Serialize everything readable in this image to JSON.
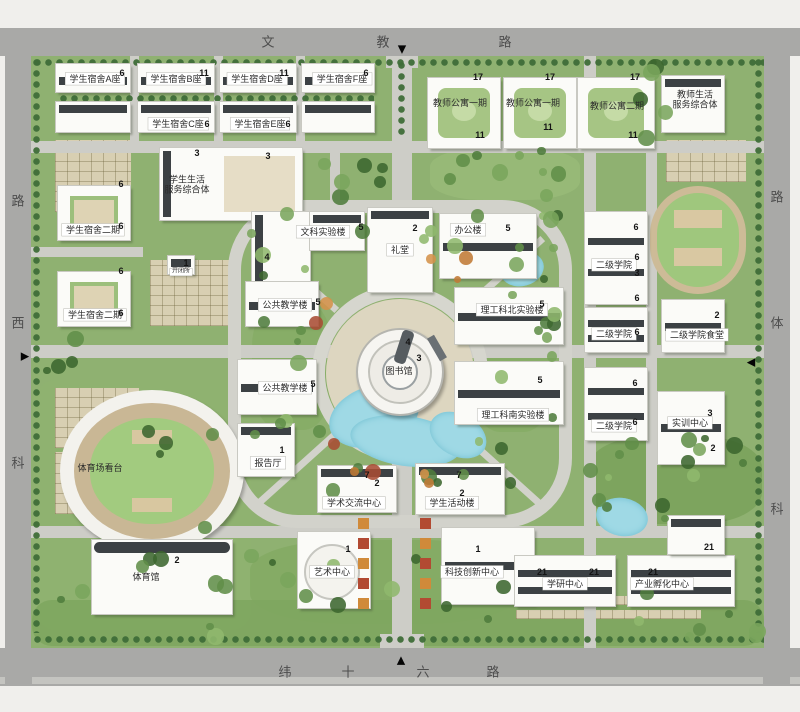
{
  "title": "校园总平面图",
  "colors": {
    "campus_green": "#8fb171",
    "road_gray": "#cdcdc7",
    "outer_road_gray": "#a9a9a7",
    "water_cyan": "#9fd9e5",
    "building_white": "#fbfbf8",
    "building_dark_bar": "#3c4144",
    "court_tan": "#d8cfb2",
    "planter_orange": "#d08a3a",
    "planter_red": "#b24a32"
  },
  "roads": {
    "north": {
      "name": "文教路",
      "chars": [
        {
          "c": "文",
          "x": 268,
          "y": 41
        },
        {
          "c": "教",
          "x": 383,
          "y": 41
        },
        {
          "c": "路",
          "x": 505,
          "y": 41
        }
      ]
    },
    "south": {
      "name": "纬十六路",
      "chars": [
        {
          "c": "纬",
          "x": 285,
          "y": 671
        },
        {
          "c": "十",
          "x": 348,
          "y": 671
        },
        {
          "c": "六",
          "x": 423,
          "y": 671
        },
        {
          "c": "路",
          "x": 493,
          "y": 671
        }
      ]
    },
    "west": {
      "name": "科西路",
      "chars": [
        {
          "c": "路",
          "x": 18,
          "y": 200
        },
        {
          "c": "西",
          "x": 18,
          "y": 322
        },
        {
          "c": "科",
          "x": 18,
          "y": 462
        }
      ]
    },
    "east": {
      "name": "科体路",
      "chars": [
        {
          "c": "路",
          "x": 777,
          "y": 196
        },
        {
          "c": "体",
          "x": 777,
          "y": 322
        },
        {
          "c": "科",
          "x": 777,
          "y": 508
        }
      ]
    }
  },
  "gates": [
    {
      "id": "north-gate",
      "sym": "▼",
      "x": 402,
      "y": 49
    },
    {
      "id": "south-gate",
      "sym": "▲",
      "x": 401,
      "y": 660
    },
    {
      "id": "west-gate",
      "sym": "▶",
      "x": 25,
      "y": 356
    },
    {
      "id": "east-gate",
      "sym": "◀",
      "x": 751,
      "y": 362
    }
  ],
  "labels": [
    {
      "id": "dorm-a",
      "text": "学生宿舍A座",
      "x": 95,
      "y": 79,
      "box": true
    },
    {
      "id": "dorm-b",
      "text": "学生宿舍B座",
      "x": 176,
      "y": 79,
      "box": true
    },
    {
      "id": "dorm-d",
      "text": "学生宿舍D座",
      "x": 257,
      "y": 79,
      "box": true
    },
    {
      "id": "dorm-f",
      "text": "学生宿舍F座",
      "x": 342,
      "y": 79,
      "box": true
    },
    {
      "id": "dorm-c",
      "text": "学生宿舍C座",
      "x": 178,
      "y": 124,
      "box": true
    },
    {
      "id": "dorm-e",
      "text": "学生宿舍E座",
      "x": 260,
      "y": 124,
      "box": true
    },
    {
      "id": "student-life-complex",
      "text": "学生生活\n服务综合体",
      "x": 187,
      "y": 185,
      "multi": true
    },
    {
      "id": "dorm-phase2-a",
      "text": "学生宿舍二期",
      "x": 93,
      "y": 230,
      "box": true
    },
    {
      "id": "dorm-phase2-b",
      "text": "学生宿舍二期",
      "x": 95,
      "y": 315,
      "box": true
    },
    {
      "id": "substation",
      "text": "开闭所",
      "x": 181,
      "y": 272,
      "box": true,
      "small": true
    },
    {
      "id": "liberal-arts-lab",
      "text": "文科实验楼",
      "x": 323,
      "y": 232,
      "box": true
    },
    {
      "id": "auditorium",
      "text": "礼堂",
      "x": 400,
      "y": 250,
      "box": true
    },
    {
      "id": "admin-building",
      "text": "办公楼",
      "x": 468,
      "y": 230,
      "box": true
    },
    {
      "id": "public-teaching-north",
      "text": "公共教学楼",
      "x": 285,
      "y": 305,
      "box": true
    },
    {
      "id": "sci-north-lab",
      "text": "理工科北实验楼",
      "x": 512,
      "y": 310,
      "box": true
    },
    {
      "id": "library",
      "text": "图书馆",
      "x": 399,
      "y": 371
    },
    {
      "id": "sci-south-lab",
      "text": "理工科南实验楼",
      "x": 513,
      "y": 415,
      "box": true
    },
    {
      "id": "public-teaching-south",
      "text": "公共教学楼",
      "x": 285,
      "y": 388,
      "box": true
    },
    {
      "id": "lecture-hall",
      "text": "报告厅",
      "x": 268,
      "y": 463,
      "box": true
    },
    {
      "id": "academic-exchange-center",
      "text": "学术交流中心",
      "x": 354,
      "y": 503,
      "box": true
    },
    {
      "id": "student-activity-building",
      "text": "学生活动楼",
      "x": 452,
      "y": 503,
      "box": true
    },
    {
      "id": "art-center",
      "text": "艺术中心",
      "x": 332,
      "y": 572,
      "box": true
    },
    {
      "id": "tech-innovation-center",
      "text": "科技创新中心",
      "x": 472,
      "y": 572,
      "box": true
    },
    {
      "id": "stadium-stands",
      "text": "体育场看台",
      "x": 100,
      "y": 468
    },
    {
      "id": "gymnasium",
      "text": "体育馆",
      "x": 146,
      "y": 577
    },
    {
      "id": "research-center",
      "text": "学研中心",
      "x": 565,
      "y": 584,
      "box": true
    },
    {
      "id": "industry-incubator",
      "text": "产业孵化中心",
      "x": 662,
      "y": 584,
      "box": true
    },
    {
      "id": "college-upper",
      "text": "二级学院",
      "x": 614,
      "y": 265,
      "box": true
    },
    {
      "id": "college-mid",
      "text": "二级学院",
      "x": 614,
      "y": 334,
      "box": true
    },
    {
      "id": "college-canteen",
      "text": "二级学院食堂",
      "x": 697,
      "y": 335,
      "box": true
    },
    {
      "id": "college-lower",
      "text": "二级学院",
      "x": 614,
      "y": 426,
      "box": true
    },
    {
      "id": "training-center",
      "text": "实训中心",
      "x": 690,
      "y": 423,
      "box": true
    },
    {
      "id": "teacher-apt-1",
      "text": "教师公寓一期",
      "x": 460,
      "y": 103
    },
    {
      "id": "teacher-apt-2",
      "text": "教师公寓一期",
      "x": 533,
      "y": 103
    },
    {
      "id": "teacher-apt-3",
      "text": "教师公寓二期",
      "x": 617,
      "y": 106
    },
    {
      "id": "teacher-life-complex",
      "text": "教师生活\n服务综合体",
      "x": 695,
      "y": 100,
      "multi": true
    }
  ],
  "floors": [
    {
      "t": "6",
      "x": 122,
      "y": 73
    },
    {
      "t": "11",
      "x": 204,
      "y": 73
    },
    {
      "t": "11",
      "x": 284,
      "y": 73
    },
    {
      "t": "6",
      "x": 366,
      "y": 73
    },
    {
      "t": "6",
      "x": 207,
      "y": 124
    },
    {
      "t": "6",
      "x": 288,
      "y": 124
    },
    {
      "t": "6",
      "x": 121,
      "y": 184
    },
    {
      "t": "6",
      "x": 121,
      "y": 226
    },
    {
      "t": "6",
      "x": 121,
      "y": 271
    },
    {
      "t": "6",
      "x": 121,
      "y": 313
    },
    {
      "t": "3",
      "x": 197,
      "y": 153
    },
    {
      "t": "3",
      "x": 268,
      "y": 156
    },
    {
      "t": "1",
      "x": 186,
      "y": 263
    },
    {
      "t": "5",
      "x": 361,
      "y": 227
    },
    {
      "t": "2",
      "x": 415,
      "y": 228
    },
    {
      "t": "5",
      "x": 508,
      "y": 228
    },
    {
      "t": "4",
      "x": 267,
      "y": 257
    },
    {
      "t": "5",
      "x": 318,
      "y": 302
    },
    {
      "t": "5",
      "x": 542,
      "y": 304
    },
    {
      "t": "4",
      "x": 408,
      "y": 342
    },
    {
      "t": "3",
      "x": 419,
      "y": 358
    },
    {
      "t": "5",
      "x": 540,
      "y": 380
    },
    {
      "t": "5",
      "x": 313,
      "y": 384
    },
    {
      "t": "1",
      "x": 282,
      "y": 450
    },
    {
      "t": "7",
      "x": 367,
      "y": 475
    },
    {
      "t": "2",
      "x": 377,
      "y": 483
    },
    {
      "t": "7",
      "x": 459,
      "y": 475
    },
    {
      "t": "2",
      "x": 462,
      "y": 493
    },
    {
      "t": "1",
      "x": 348,
      "y": 549
    },
    {
      "t": "1",
      "x": 478,
      "y": 549
    },
    {
      "t": "2",
      "x": 177,
      "y": 560
    },
    {
      "t": "21",
      "x": 542,
      "y": 572
    },
    {
      "t": "21",
      "x": 594,
      "y": 572
    },
    {
      "t": "21",
      "x": 653,
      "y": 572
    },
    {
      "t": "21",
      "x": 709,
      "y": 547
    },
    {
      "t": "17",
      "x": 478,
      "y": 77
    },
    {
      "t": "11",
      "x": 480,
      "y": 135
    },
    {
      "t": "17",
      "x": 550,
      "y": 77
    },
    {
      "t": "11",
      "x": 548,
      "y": 127
    },
    {
      "t": "17",
      "x": 635,
      "y": 77
    },
    {
      "t": "11",
      "x": 633,
      "y": 135
    },
    {
      "t": "6",
      "x": 636,
      "y": 227
    },
    {
      "t": "6",
      "x": 637,
      "y": 257
    },
    {
      "t": "3",
      "x": 637,
      "y": 273
    },
    {
      "t": "6",
      "x": 637,
      "y": 298
    },
    {
      "t": "6",
      "x": 637,
      "y": 332
    },
    {
      "t": "2",
      "x": 717,
      "y": 315
    },
    {
      "t": "6",
      "x": 635,
      "y": 383
    },
    {
      "t": "6",
      "x": 635,
      "y": 422
    },
    {
      "t": "3",
      "x": 710,
      "y": 413
    },
    {
      "t": "2",
      "x": 713,
      "y": 448
    }
  ]
}
